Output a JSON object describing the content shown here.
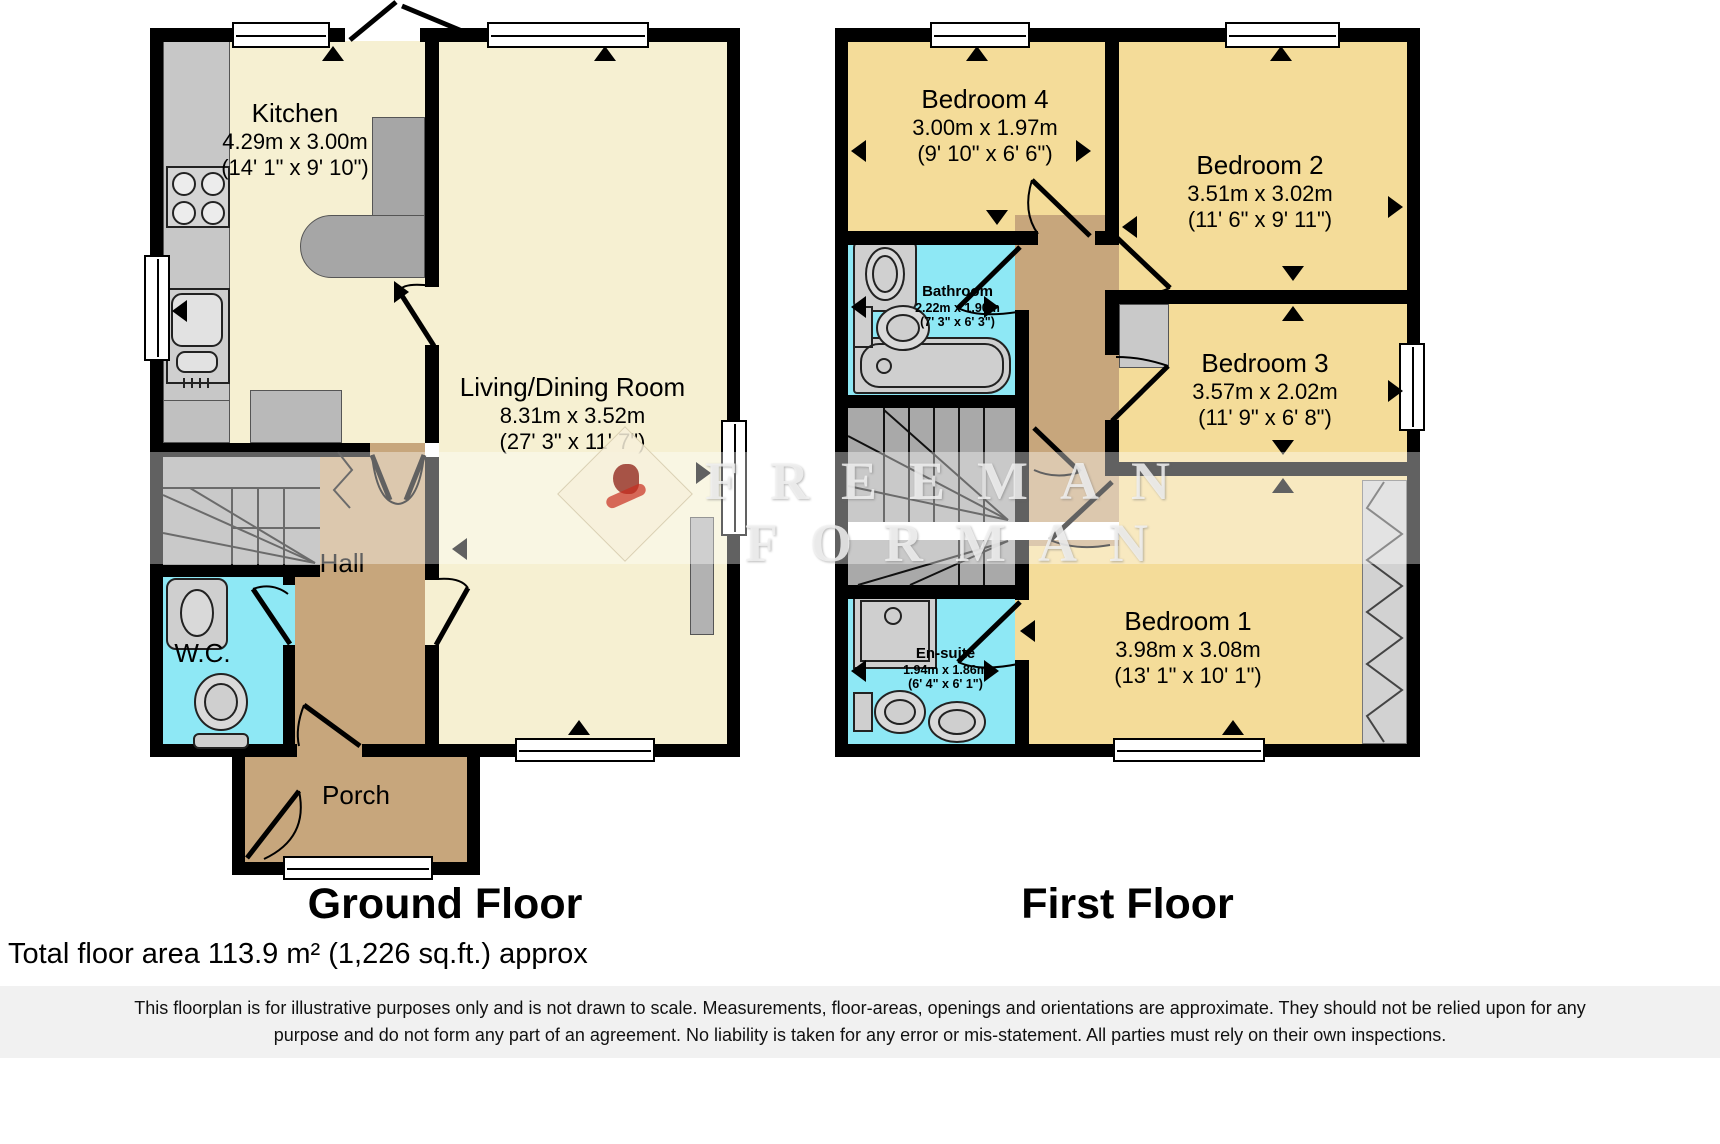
{
  "watermark": {
    "line1": "FREEMAN",
    "line2": "FORMAN"
  },
  "ground_floor": {
    "title": "Ground Floor",
    "kitchen": {
      "name": "Kitchen",
      "metric": "4.29m x 3.00m",
      "imperial": "(14' 1\" x 9' 10\")"
    },
    "living": {
      "name": "Living/Dining Room",
      "metric": "8.31m x 3.52m",
      "imperial": "(27' 3\" x 11' 7\")"
    },
    "hall": {
      "name": "Hall"
    },
    "wc": {
      "name": "W.C."
    },
    "porch": {
      "name": "Porch"
    }
  },
  "first_floor": {
    "title": "First Floor",
    "bedroom4": {
      "name": "Bedroom 4",
      "metric": "3.00m x 1.97m",
      "imperial": "(9' 10\" x 6' 6\")"
    },
    "bedroom2": {
      "name": "Bedroom 2",
      "metric": "3.51m x 3.02m",
      "imperial": "(11' 6\" x 9' 11\")"
    },
    "bathroom": {
      "name": "Bathroom",
      "metric": "2.22m x 1.90m",
      "imperial": "(7' 3\" x 6' 3\")"
    },
    "bedroom3": {
      "name": "Bedroom 3",
      "metric": "3.57m x 2.02m",
      "imperial": "(11' 9\" x 6' 8\")"
    },
    "bedroom1": {
      "name": "Bedroom 1",
      "metric": "3.98m x 3.08m",
      "imperial": "(13' 1\" x 10' 1\")"
    },
    "ensuite": {
      "name": "En-suite",
      "metric": "1.94m x 1.86m",
      "imperial": "(6' 4\" x 6' 1\")"
    }
  },
  "footer": {
    "total_area": "Total floor area 113.9 m² (1,226 sq.ft.) approx",
    "disclaimer_line1": "This floorplan is for illustrative purposes only and is not drawn to scale. Measurements, floor-areas, openings and orientations are approximate. They should not be relied upon for any",
    "disclaimer_line2": "purpose and do not form any part of an agreement. No liability is taken for any error or mis-statement. All parties must rely on their own inspections."
  }
}
